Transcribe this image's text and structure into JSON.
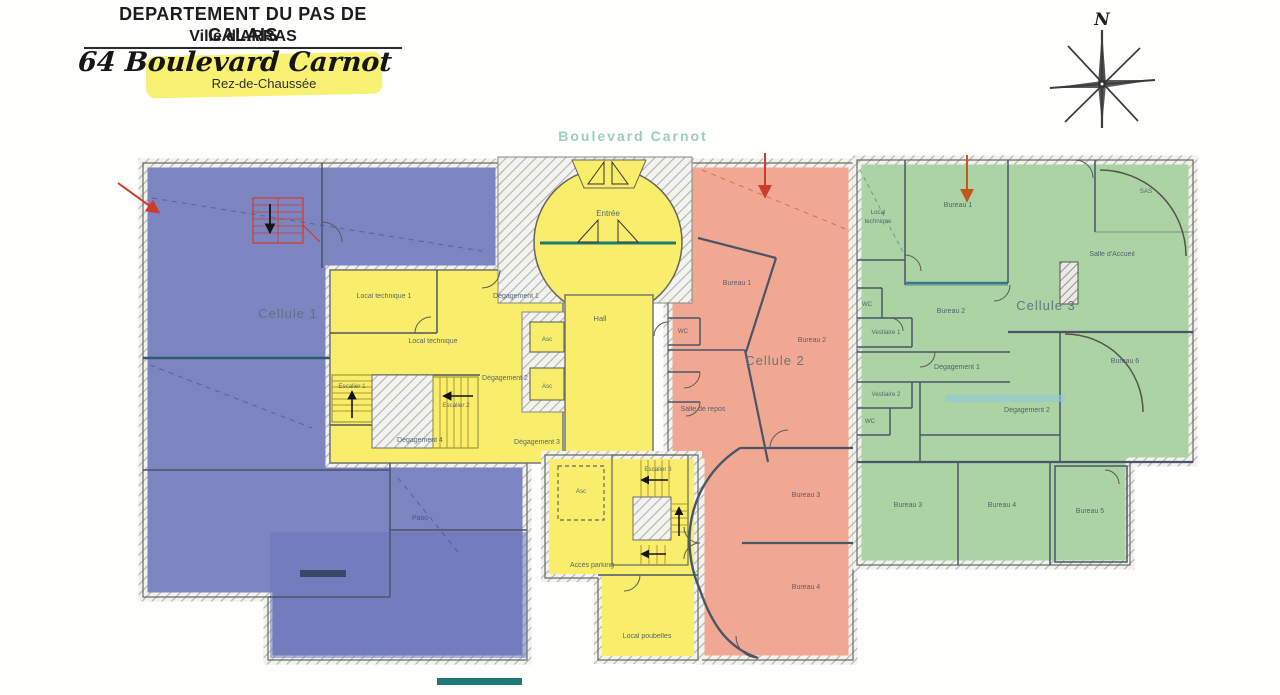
{
  "header": {
    "line1": "DEPARTEMENT DU PAS DE CALAIS",
    "line2": "Ville d'ARRAS",
    "line3": "64 Boulevard Carnot",
    "line4": "Rez-de-Chaussée"
  },
  "street_label": "Boulevard Carnot",
  "compass": {
    "north": "N"
  },
  "zones": {
    "cellule1_label": "Cellule 1",
    "cellule2_label": "Cellule 2",
    "cellule3_label": "Cellule 3"
  },
  "rooms_common": {
    "entree": "Entrée",
    "hall": "Hall",
    "local_technique_1": "Local technique 1",
    "local_technique": "Local technique",
    "degagement_1": "Dégagement 1",
    "degagement_2": "Dégagement 2",
    "degagement_3": "Dégagement 3",
    "degagement_4": "Dégagement 4",
    "ascenseur": "Asc",
    "escalier_1": "Escalier 1",
    "escalier_2": "Escalier 2",
    "escalier_3": "Escalier 3",
    "acces_parking": "Accès parking",
    "local_poubelles": "Local poubelles"
  },
  "rooms_cellule1": {
    "patio": "Patio"
  },
  "rooms_cellule2": {
    "bureau_1": "Bureau 1",
    "bureau_2": "Bureau 2",
    "bureau_3": "Bureau 3",
    "bureau_4": "Bureau 4",
    "wc": "WC",
    "salle_de_repos": "Salle de repos"
  },
  "rooms_cellule3": {
    "local_technique_line1": "Local",
    "local_technique_line2": "technique",
    "bureau_1": "Bureau 1",
    "sas": "SAS",
    "salle_accueil": "Salle d'Accueil",
    "wc_1": "WC",
    "bureau_2": "Bureau 2",
    "vestiaire_1": "Vestiaire 1",
    "degagement_1": "Dégagement 1",
    "vestiaire_2": "Vestiaire 2",
    "wc_2": "WC",
    "degagement_2": "Dégagement 2",
    "bureau_6": "Bureau 6",
    "bureau_3": "Bureau 3",
    "bureau_4": "Bureau 4",
    "bureau_5": "Bureau 5"
  },
  "colors": {
    "cellule1": "#7d85c1",
    "cellule2": "#f1a892",
    "cellule3": "#abd3a3",
    "commons": "#f8ee6b",
    "teal_accent": "#1e7a74",
    "red_annotation": "#cf3a2a",
    "orange_annotation": "#c2571f",
    "highlight": "#f8f06a",
    "street_text": "#9ccfba"
  }
}
